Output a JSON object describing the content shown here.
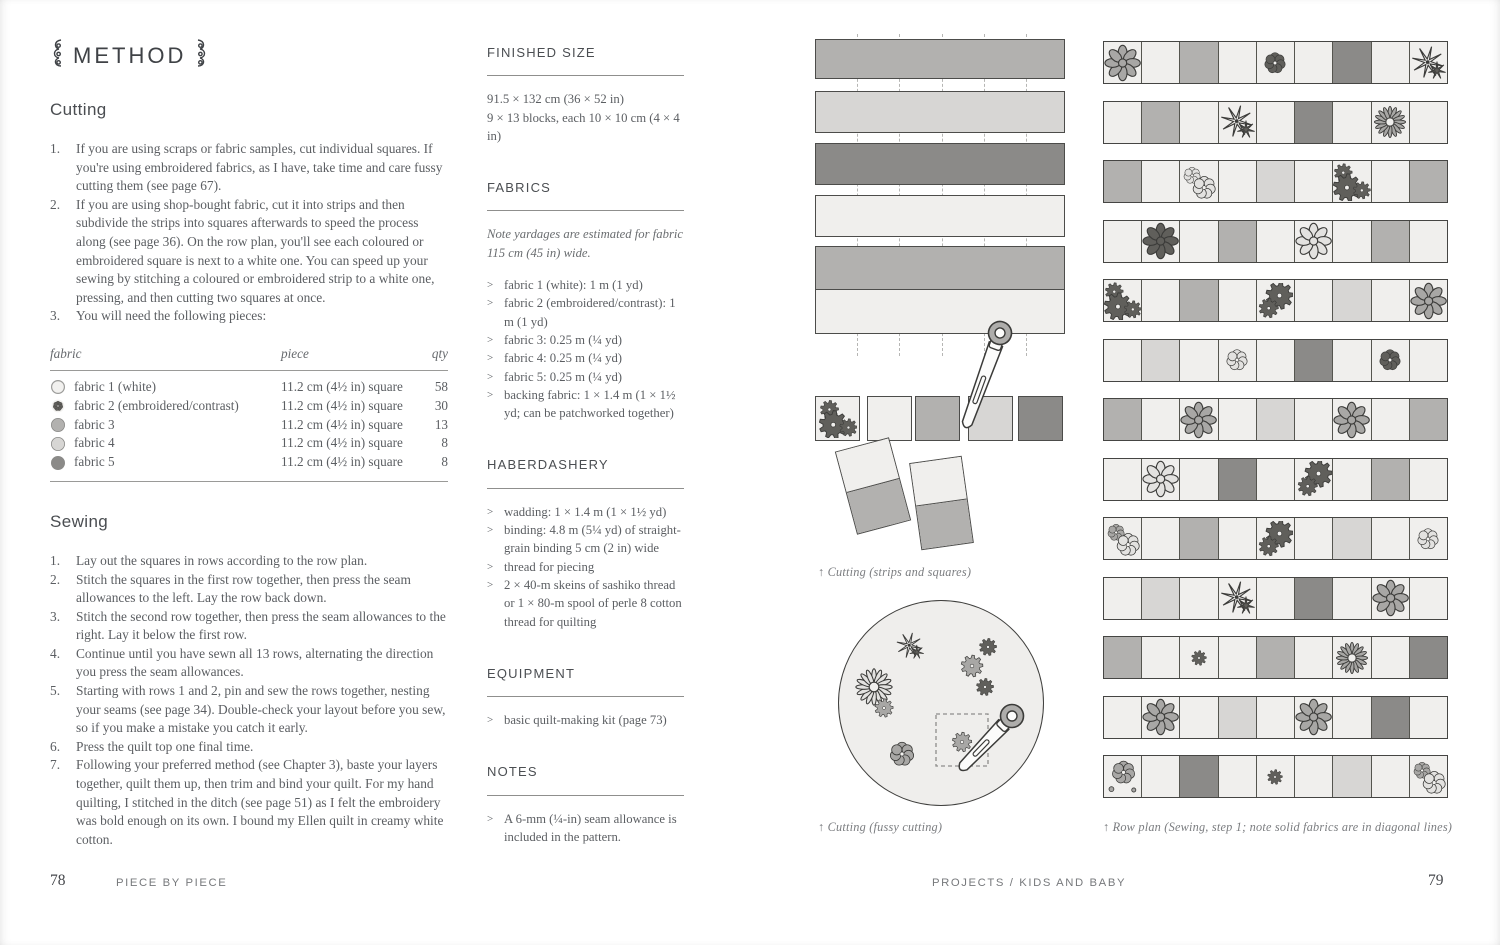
{
  "palette": {
    "white_fabric": "#f0efed",
    "light_gray": "#d7d6d4",
    "mid_gray": "#b2b1af",
    "dark_gray": "#8b8a88",
    "outline": "#3b3b39",
    "motif_light": "#e3e2e0",
    "motif_mid": "#a8a7a5",
    "motif_dark": "#605f5b"
  },
  "left_page": {
    "page_number": "78",
    "footer_book_title": "PIECE BY PIECE",
    "method_title": "METHOD",
    "cutting": {
      "heading": "Cutting",
      "steps": [
        "If you are using scraps or fabric samples, cut individual squares. If you're using embroidered fabrics, as I have, take time and care fussy cutting them (see page 67).",
        "If you are using shop-bought fabric, cut it into strips and then subdivide the strips into squares afterwards to speed the process along (see page 36). On the row plan, you'll see each coloured or embroidered square is next to a white one. You can speed up your sewing by stitching a coloured or embroidered strip to a white one, pressing, and then cutting two squares at once.",
        "You will need the following pieces:"
      ]
    },
    "fabric_table": {
      "headers": [
        "fabric",
        "piece",
        "qty"
      ],
      "rows": [
        {
          "swatch": "white",
          "fabric": "fabric 1 (white)",
          "piece": "11.2 cm (4½ in) square",
          "qty": "58"
        },
        {
          "swatch": "embroidered",
          "fabric": "fabric 2 (embroidered/contrast)",
          "piece": "11.2 cm (4½ in) square",
          "qty": "30"
        },
        {
          "swatch": "mid",
          "fabric": "fabric 3",
          "piece": "11.2 cm (4½ in) square",
          "qty": "13"
        },
        {
          "swatch": "light",
          "fabric": "fabric 4",
          "piece": "11.2 cm (4½ in) square",
          "qty": "8"
        },
        {
          "swatch": "dark",
          "fabric": "fabric 5",
          "piece": "11.2 cm (4½ in) square",
          "qty": "8"
        }
      ]
    },
    "sewing": {
      "heading": "Sewing",
      "steps": [
        "Lay out the squares in rows according to the row plan.",
        "Stitch the squares in the first row together, then press the seam allowances to the left. Lay the row back down.",
        "Stitch the second row together, then press the seam allowances to the right. Lay it below the first row.",
        "Continue until you have sewn all 13 rows, alternating the direction you press the seam allowances.",
        "Starting with rows 1 and 2, pin and sew the rows together, nesting your seams (see page 34). Double-check your layout before you sew, so if you make a mistake you catch it early.",
        "Press the quilt top one final time.",
        "Following your preferred method (see Chapter 3), baste your layers together, quilt them up, then trim and bind your quilt. For my hand quilting, I stitched in the ditch (see page 51) as I felt the embroidery was bold enough on its own. I bound my Ellen quilt in creamy white cotton."
      ]
    }
  },
  "info_column": {
    "sections": [
      {
        "title": "FINISHED SIZE",
        "lines": [
          "91.5 × 132 cm (36 × 52 in)",
          "9 × 13 blocks, each 10 × 10 cm (4 × 4 in)"
        ],
        "bullets": []
      },
      {
        "title": "FABRICS",
        "note": "Note yardages are estimated for fabric 115 cm (45 in) wide.",
        "lines": [],
        "bullets": [
          "fabric 1 (white): 1 m (1 yd)",
          "fabric 2 (embroidered/contrast): 1 m (1 yd)",
          "fabric 3: 0.25 m (¼ yd)",
          "fabric 4: 0.25 m (¼ yd)",
          "fabric 5: 0.25 m (¼ yd)",
          "backing fabric: 1 × 1.4 m (1 × 1½ yd; can be patchworked together)"
        ]
      },
      {
        "title": "HABERDASHERY",
        "lines": [],
        "bullets": [
          "wadding: 1 × 1.4 m (1 × 1½ yd)",
          "binding: 4.8 m (5¼ yd) of straight-grain binding 5 cm (2 in) wide",
          "thread for piecing",
          "2 × 40-m skeins of sashiko thread or 1 × 80-m spool of perle 8 cotton thread for quilting"
        ]
      },
      {
        "title": "EQUIPMENT",
        "lines": [],
        "bullets": [
          "basic quilt-making kit (page 73)"
        ]
      },
      {
        "title": "NOTES",
        "lines": [],
        "bullets": [
          "A 6-mm (¼-in) seam allowance is included in the pattern."
        ]
      }
    ]
  },
  "right_page": {
    "page_number": "79",
    "footer_section": "PROJECTS / KIDS AND BABY",
    "strips_figure": {
      "caption": "↑  Cutting (strips and squares)",
      "strips": [
        "M",
        "L",
        "D",
        "W",
        "double"
      ],
      "strip_tops": [
        5,
        57,
        109,
        161,
        212
      ],
      "strip_heights": [
        40,
        42,
        42,
        42,
        88
      ],
      "dash_xs": [
        42,
        84,
        127,
        169,
        211
      ],
      "squares": [
        "F:gears3:dark",
        "W",
        "M",
        "L",
        "D"
      ],
      "square_xs": [
        0,
        52,
        100,
        153,
        203
      ],
      "squares_top": 362,
      "pairs": [
        {
          "cx": 58,
          "cy": 452,
          "w": 56,
          "h": 86,
          "rot": -15
        },
        {
          "cx": 126,
          "cy": 469,
          "w": 53,
          "h": 88,
          "rot": -8
        }
      ],
      "cutter": {
        "x": 185,
        "y": 299,
        "rot": 20,
        "len": 96
      }
    },
    "fussy_figure": {
      "caption": "↑  Cutting (fussy cutting)",
      "motifs": [
        {
          "type": "star",
          "tone": "light",
          "cx": 74,
          "cy": 48,
          "s": 30
        },
        {
          "type": "gear",
          "tone": "dark",
          "cx": 152,
          "cy": 49,
          "s": 30
        },
        {
          "type": "gear",
          "tone": "mid",
          "cx": 136,
          "cy": 68,
          "s": 38
        },
        {
          "type": "gear",
          "tone": "dark",
          "cx": 149,
          "cy": 89,
          "s": 30
        },
        {
          "type": "sunburst",
          "tone": "light",
          "cx": 38,
          "cy": 89,
          "s": 42
        },
        {
          "type": "gear",
          "tone": "mid",
          "cx": 48,
          "cy": 110,
          "s": 32
        },
        {
          "type": "swirl",
          "tone": "mid",
          "cx": 66,
          "cy": 156,
          "s": 32
        },
        {
          "type": "gear",
          "tone": "mid",
          "cx": 126,
          "cy": 144,
          "s": 34
        }
      ],
      "dashed_box": {
        "x": 100,
        "y": 116,
        "w": 52,
        "h": 52
      },
      "cutter": {
        "x": 176,
        "y": 118,
        "rot": 44,
        "len": 70
      }
    },
    "row_plan": {
      "caption": "↑  Row plan (Sewing, step 1; note solid fabrics are in diagonal lines)",
      "rows": [
        [
          "F:daisy:mid",
          "W",
          "M",
          "W",
          "F:swirl:dark",
          "W",
          "D",
          "W",
          "F:star:dark"
        ],
        [
          "W",
          "M",
          "W",
          "F:star:dark",
          "W",
          "D",
          "W",
          "F:sunburst:mid",
          "W"
        ],
        [
          "M",
          "W",
          "F:swirl2:light",
          "W",
          "L",
          "W",
          "F:gears3:dark",
          "W",
          "M"
        ],
        [
          "W",
          "F:daisy:dark",
          "W",
          "M",
          "W",
          "F:daisy:light",
          "W",
          "M",
          "W"
        ],
        [
          "F:gears3:dark",
          "W",
          "M",
          "W",
          "F:gears2:dark",
          "W",
          "L",
          "W",
          "F:daisy:mid"
        ],
        [
          "W",
          "L",
          "W",
          "F:swirl:light",
          "W",
          "D",
          "W",
          "F:swirl:dark",
          "W"
        ],
        [
          "M",
          "W",
          "F:daisy:mid",
          "W",
          "L",
          "W",
          "F:daisy:mid",
          "W",
          "M"
        ],
        [
          "W",
          "F:daisy:light",
          "W",
          "D",
          "W",
          "F:gears2:dark",
          "W",
          "M",
          "W"
        ],
        [
          "F:swirl2:mid",
          "W",
          "M",
          "W",
          "F:gears2:dark",
          "W",
          "L",
          "W",
          "F:swirl:light"
        ],
        [
          "W",
          "L",
          "W",
          "F:star:dark",
          "W",
          "D",
          "W",
          "F:daisy:mid",
          "W"
        ],
        [
          "M",
          "W",
          "F:gear:dark",
          "W",
          "M",
          "W",
          "F:sunburst:mid",
          "W",
          "D"
        ],
        [
          "W",
          "F:daisy:mid",
          "W",
          "L",
          "W",
          "F:daisy:mid",
          "W",
          "D",
          "W"
        ],
        [
          "F:swirldots:mid",
          "W",
          "D",
          "W",
          "F:gear:dark",
          "W",
          "L",
          "W",
          "F:swirl2:mid"
        ]
      ]
    }
  }
}
